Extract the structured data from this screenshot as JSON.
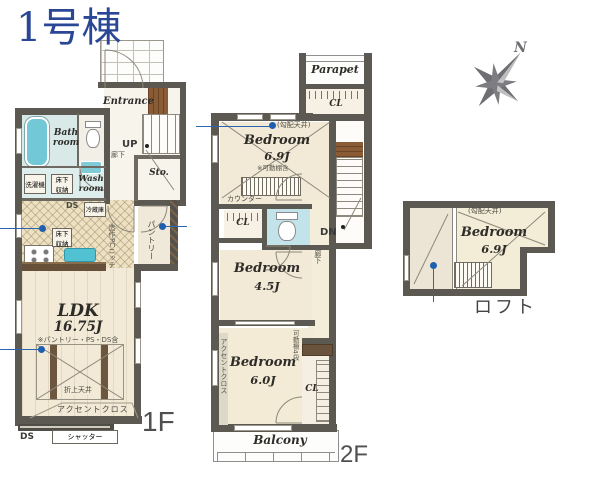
{
  "title": "1号棟",
  "compass": {
    "north": "N"
  },
  "floor1": {
    "label": "1F",
    "entrance": "Entrance",
    "up": "UP",
    "storage": "Sto.",
    "hallway": "廊下",
    "bath_room": "Bath\nroom",
    "wash_room": "Wash\nroom",
    "washing_machine": "洗濯機",
    "underfloor_storage": "床下\n収納",
    "ds_top": "DS",
    "refrigerator": "冷蔵庫",
    "pantry": "パントリー",
    "pc_niche": "造作PCニッチ",
    "ldk_name": "LDK",
    "ldk_size": "16.75J",
    "ldk_note": "※パントリー・PS・DS含",
    "coffered_ceiling": "折上天井",
    "accent_cloth": "アクセントクロス",
    "shutter": "シャッター",
    "ds_bottom": "DS"
  },
  "floor2": {
    "label": "2F",
    "parapet": "Parapet",
    "closet": "CL",
    "sloped_ceiling": "(勾配天井)",
    "bedroom69_name": "Bedroom",
    "bedroom69_size": "6.9J",
    "bedroom69_note": "※可動棚含",
    "counter": "カウンター",
    "down": "DN",
    "hallway": "廊下",
    "bedroom45_name": "Bedroom",
    "bedroom45_size": "4.5J",
    "bedroom60_name": "Bedroom",
    "bedroom60_size": "6.0J",
    "accent_cloth": "アクセントクロス",
    "movable_shelf": "可動棚4段",
    "balcony": "Balcony"
  },
  "loft": {
    "label": "ロフト",
    "sloped_ceiling": "(勾配天井)",
    "bedroom_name": "Bedroom",
    "bedroom_size": "6.9J"
  },
  "colors": {
    "accent_blue": "#2a4795",
    "marker_blue": "#1f5fae",
    "wall_gray": "#5c5952",
    "floor_cream": "#f2ead7",
    "water_teal": "#6ec9d8"
  }
}
